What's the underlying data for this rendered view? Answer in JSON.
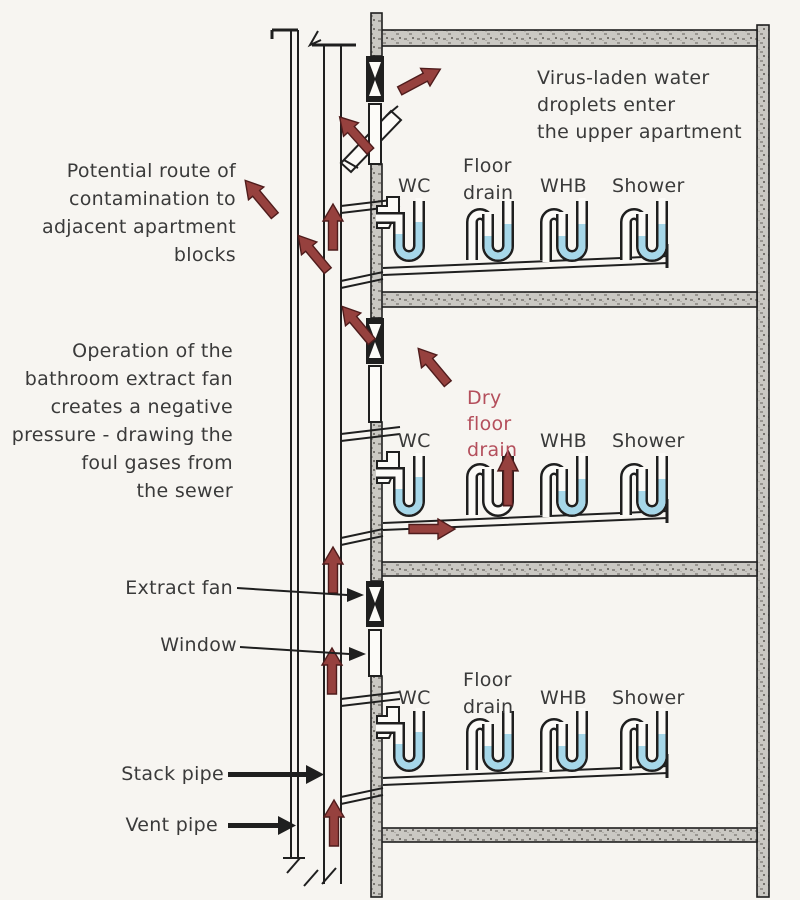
{
  "colors": {
    "bg": "#f7f5f1",
    "ink": "#1f1f1f",
    "note": "#3a3a3a",
    "arrow": "#96413e",
    "arrow_edge": "#4f1c1c",
    "dry": "#b44f5c",
    "water": "#a6d7e9",
    "wall": "#cac8c3",
    "paper": "#fcfbf8"
  },
  "notes": {
    "virus": [
      "Virus-laden water",
      "droplets enter",
      "the upper apartment"
    ],
    "contamination": [
      "Potential route of",
      "contamination to",
      "adjacent apartment",
      "blocks"
    ],
    "extract_fan": [
      "Operation of the",
      "bathroom extract fan",
      "creates a negative",
      "pressure - drawing the",
      "foul gases from",
      "the sewer"
    ]
  },
  "callouts": {
    "extract_fan": "Extract fan",
    "window": "Window",
    "stack_pipe": "Stack pipe",
    "vent_pipe": "Vent pipe"
  },
  "floors": [
    {
      "level": "upper",
      "wc": "WC",
      "floor_drain_line1": "Floor",
      "floor_drain_line2": "drain",
      "whb": "WHB",
      "shower": "Shower",
      "floor_drain_state": "wet"
    },
    {
      "level": "middle",
      "wc": "WC",
      "dry_drain_line1": "Dry",
      "dry_drain_line2": "floor",
      "dry_drain_line3": "drain",
      "whb": "WHB",
      "shower": "Shower",
      "floor_drain_state": "dry"
    },
    {
      "level": "lower",
      "wc": "WC",
      "floor_drain_line1": "Floor",
      "floor_drain_line2": "drain",
      "whb": "WHB",
      "shower": "Shower",
      "floor_drain_state": "wet"
    }
  ]
}
